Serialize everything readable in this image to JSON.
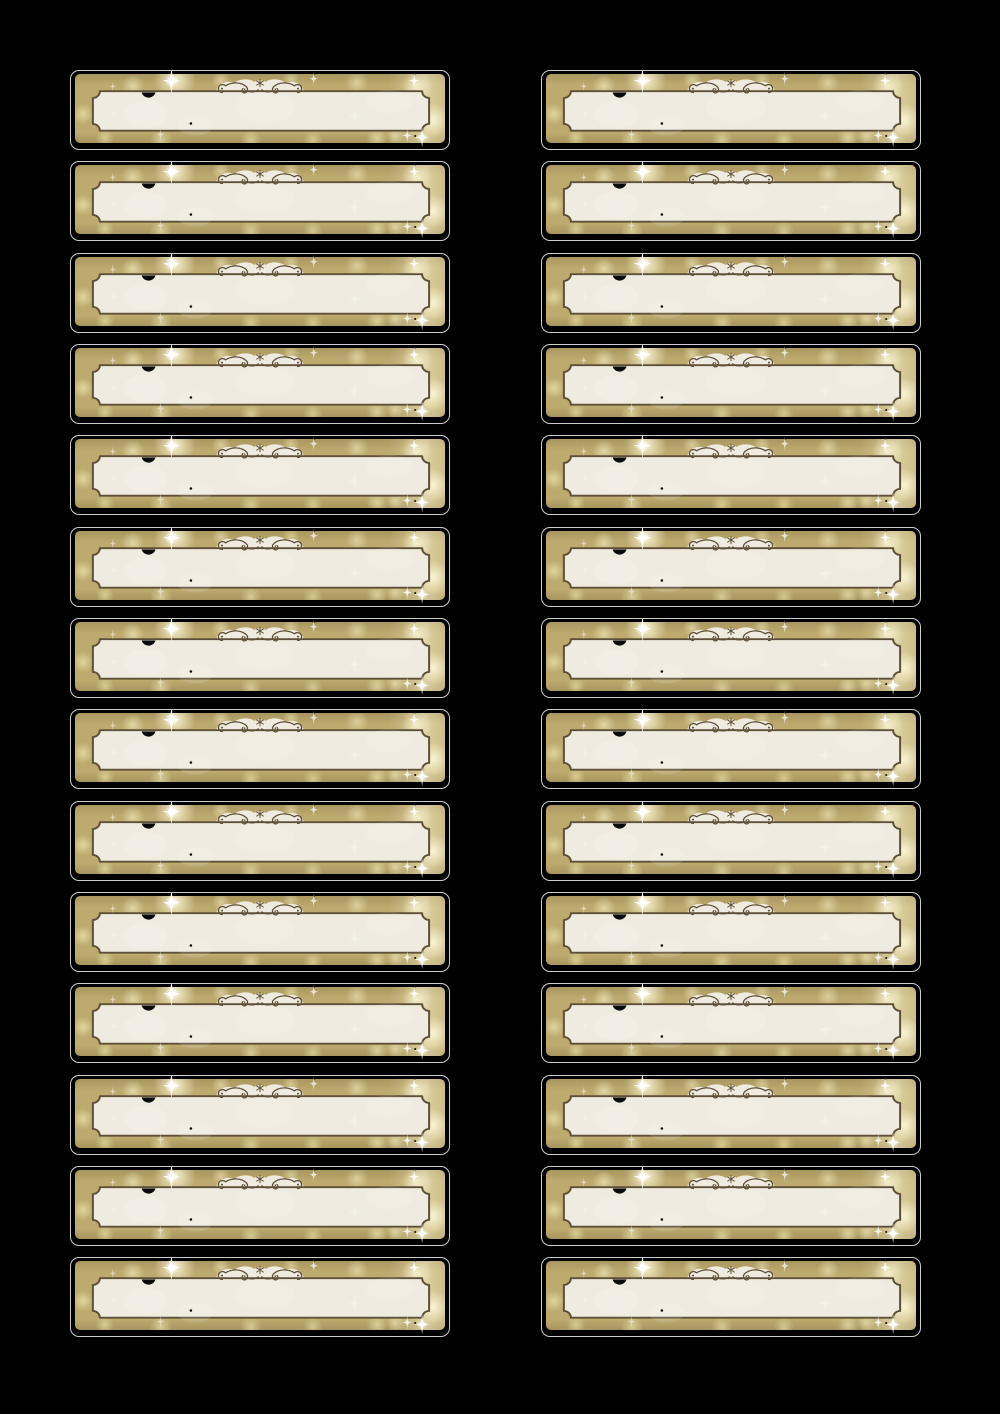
{
  "page": {
    "background_color": "#000000",
    "width_px": 1000,
    "height_px": 1414,
    "description": "Printable sheet of blank gold bokeh labels, no text"
  },
  "sheet": {
    "columns": 2,
    "rows": 14,
    "label_count": 28,
    "column_left_px": [
      70,
      541
    ],
    "first_row_top_px": 70,
    "row_pitch_px": 91.33,
    "label_width_px": 380,
    "label_height_px": 80
  },
  "label": {
    "text": "",
    "ornament_icon": "flourish-scroll-ornament",
    "sparkle_icon": "four-point-star-sparkle",
    "frame_style": "notched-corner certificate frame",
    "colors": {
      "outline": "#cdcdcd",
      "gold_base": "#bcaa6e",
      "gold_edge_shade": "#9c8a55",
      "bokeh_light": "#f7f1cf",
      "bokeh_yellow": "#e8df9f",
      "panel_cream": "#f0ebe0",
      "frame_brown": "#5e5038",
      "sparkle_white": "#ffffff",
      "speck_black": "#0a0a0a"
    }
  }
}
